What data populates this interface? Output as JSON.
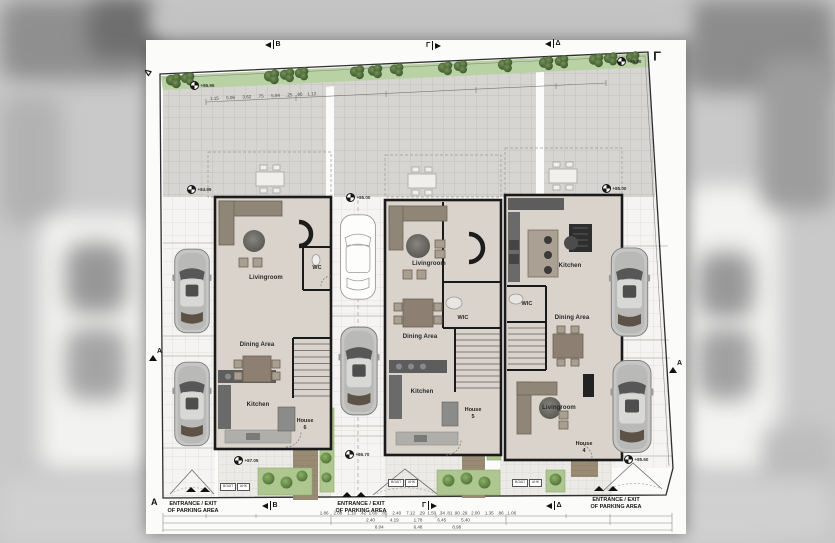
{
  "markers": {
    "a": "A",
    "b": "B",
    "gamma": "Γ",
    "delta": "Δ"
  },
  "corner_label": "Γ",
  "houses": [
    {
      "name": "House",
      "number": "6",
      "living": "Livingroom",
      "dining": "Dining Area",
      "kitchen": "Kitchen",
      "wc": "WC"
    },
    {
      "name": "House",
      "number": "5",
      "living": "Livingroom",
      "dining": "Dining Area",
      "kitchen": "Kitchen",
      "wc": "WIC"
    },
    {
      "name": "House",
      "number": "4",
      "living": "Livingroom",
      "dining": "Dining Area",
      "kitchen": "Kitchen",
      "wc": "WIC"
    }
  ],
  "entrance": {
    "line1": "ENTRANCE / EXIT",
    "line2": "OF PARKING AREA"
  },
  "utilities": {
    "box1": "ΒΟΑΠ",
    "box2": "ΑΗΚ"
  },
  "elevations": [
    "+85.95",
    "+84.95",
    "+85.00",
    "+85.00",
    "+85.80",
    "+87.05",
    "+86.70",
    "+85.60"
  ],
  "dimensions": {
    "top": "1.15      5.06      3.62     .75      5.94     .25   .90    1.12",
    "row1": "1.86    2.88    1.10   .42  1.60   .85    2.40    7.12   .29  1.50  .34 .81 .90 .29   2.00    1.35   .86   1.06",
    "row2": "2.40            4.19            1.78            6.45            5.40",
    "row3": "8.04                        6.48                        8.98"
  },
  "colors": {
    "wall": "#1a1a1a",
    "floor": "#dad3cb",
    "terrace": "#d6d5d2",
    "green_strip": "#b9d2a3",
    "tree": "#45603а",
    "deck": "#998a73",
    "paper": "#fbfbfa"
  }
}
